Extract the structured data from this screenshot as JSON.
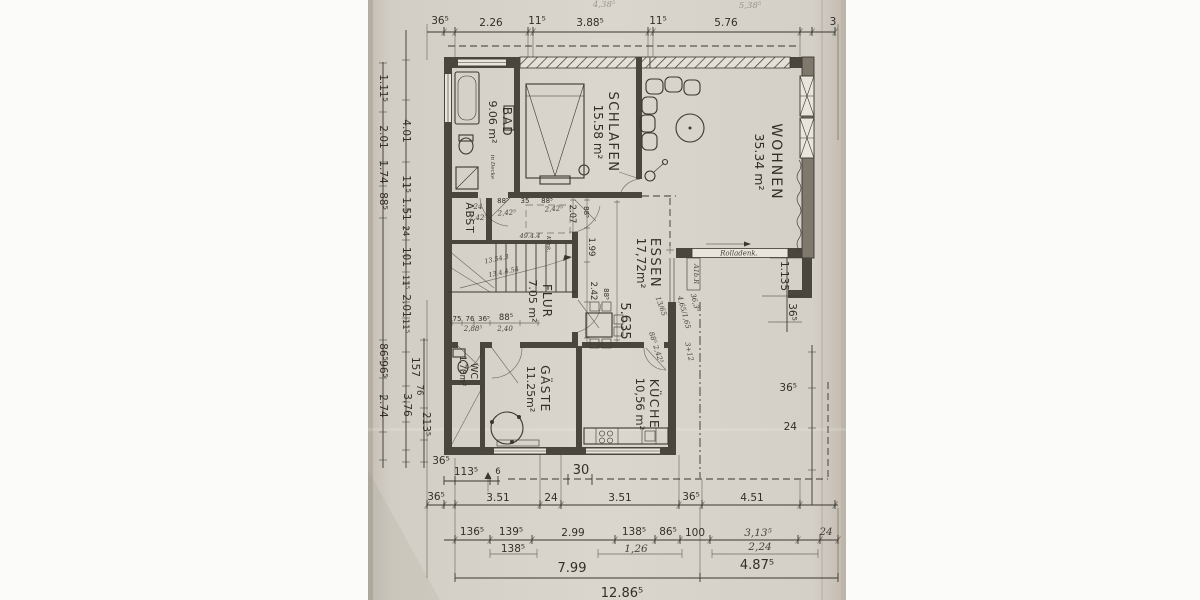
{
  "colors": {
    "paper": "#d6d1c9",
    "paper_edge": "#c3bcb2",
    "ink": "#35312a",
    "wall": "#4b463d"
  },
  "rooms": {
    "bad": {
      "name": "BAD",
      "area": "9.06 m²"
    },
    "schlafen": {
      "name": "SCHLAFEN",
      "area": "15.58 m²"
    },
    "wohnen": {
      "name": "WOHNEN",
      "area": "35.34 m²"
    },
    "essen": {
      "name": "ESSEN",
      "area": "17,72m²"
    },
    "flur": {
      "name": "FLUR",
      "area": "7.05 m²"
    },
    "abst": {
      "name": "ABST"
    },
    "wc": {
      "name": "WC",
      "area": "1.78m²"
    },
    "gaeste": {
      "name": "GÄSTE",
      "area": "11.25m²"
    },
    "kueche": {
      "name": "KÜCHE",
      "area": "10,56 m²"
    }
  },
  "dims": {
    "top": {
      "corner": "36⁵",
      "r": [
        "2.26",
        "11⁵",
        "3.88⁵",
        "11⁵",
        "5.76"
      ],
      "cut": "3",
      "faint": [
        "4,38⁵",
        "5,38⁵"
      ]
    },
    "left_outer": [
      "1.11⁵",
      "2.01",
      "1.74",
      "88⁵",
      "86⁵",
      "96⁵",
      "2.74"
    ],
    "left_inner": [
      "4.01",
      "11⁵",
      "1.51",
      "24",
      "101",
      "11⁵",
      "2.01",
      "11⁵",
      "157",
      "76",
      "3.76",
      "213⁵"
    ],
    "left_corner": "36⁵",
    "right": [
      "36⁵",
      "24"
    ],
    "wohnen_right": [
      "1.135",
      "36⁵"
    ],
    "bottom0": [
      "113⁵",
      "6",
      "30"
    ],
    "bottom1": [
      "36⁵",
      "3.51",
      "24",
      "3.51",
      "36⁵",
      "4.51"
    ],
    "bottom2": [
      "136⁵",
      "139⁵",
      "2.99",
      "138⁵",
      "86⁵",
      "100",
      "3,13⁵",
      "24"
    ],
    "bottom3": [
      "138⁵",
      "1,26",
      "2,24"
    ],
    "bottom4": [
      "7.99",
      "4.87⁵"
    ],
    "bottom5": "12.86⁵",
    "corridor": [
      "88⁵",
      "35",
      "88⁵"
    ],
    "essen_west": [
      "2.07",
      "88⁵",
      "1.99",
      "2.42",
      "88⁵"
    ],
    "essen_depth": "5.635",
    "flur_bottom": [
      "75",
      "76",
      "36⁵",
      "88⁵"
    ]
  },
  "handwritten": {
    "corridor": [
      "24",
      "2,42⁵",
      "2,42⁵",
      "2,42⁵",
      "49.4.4"
    ],
    "flur": [
      "2,88⁵",
      "2,40"
    ],
    "stairs": [
      "13.54.3",
      "13.4.4.54"
    ],
    "right_margin": [
      "A1b.R",
      "36,3⁵",
      "4,65/1,65",
      "13/65",
      "88⁵ 2,42⁵",
      "3+12"
    ],
    "klinker": "Klink.",
    "bad_note": "in Decke"
  },
  "annotations": {
    "rolladen": "Rolladenk."
  }
}
